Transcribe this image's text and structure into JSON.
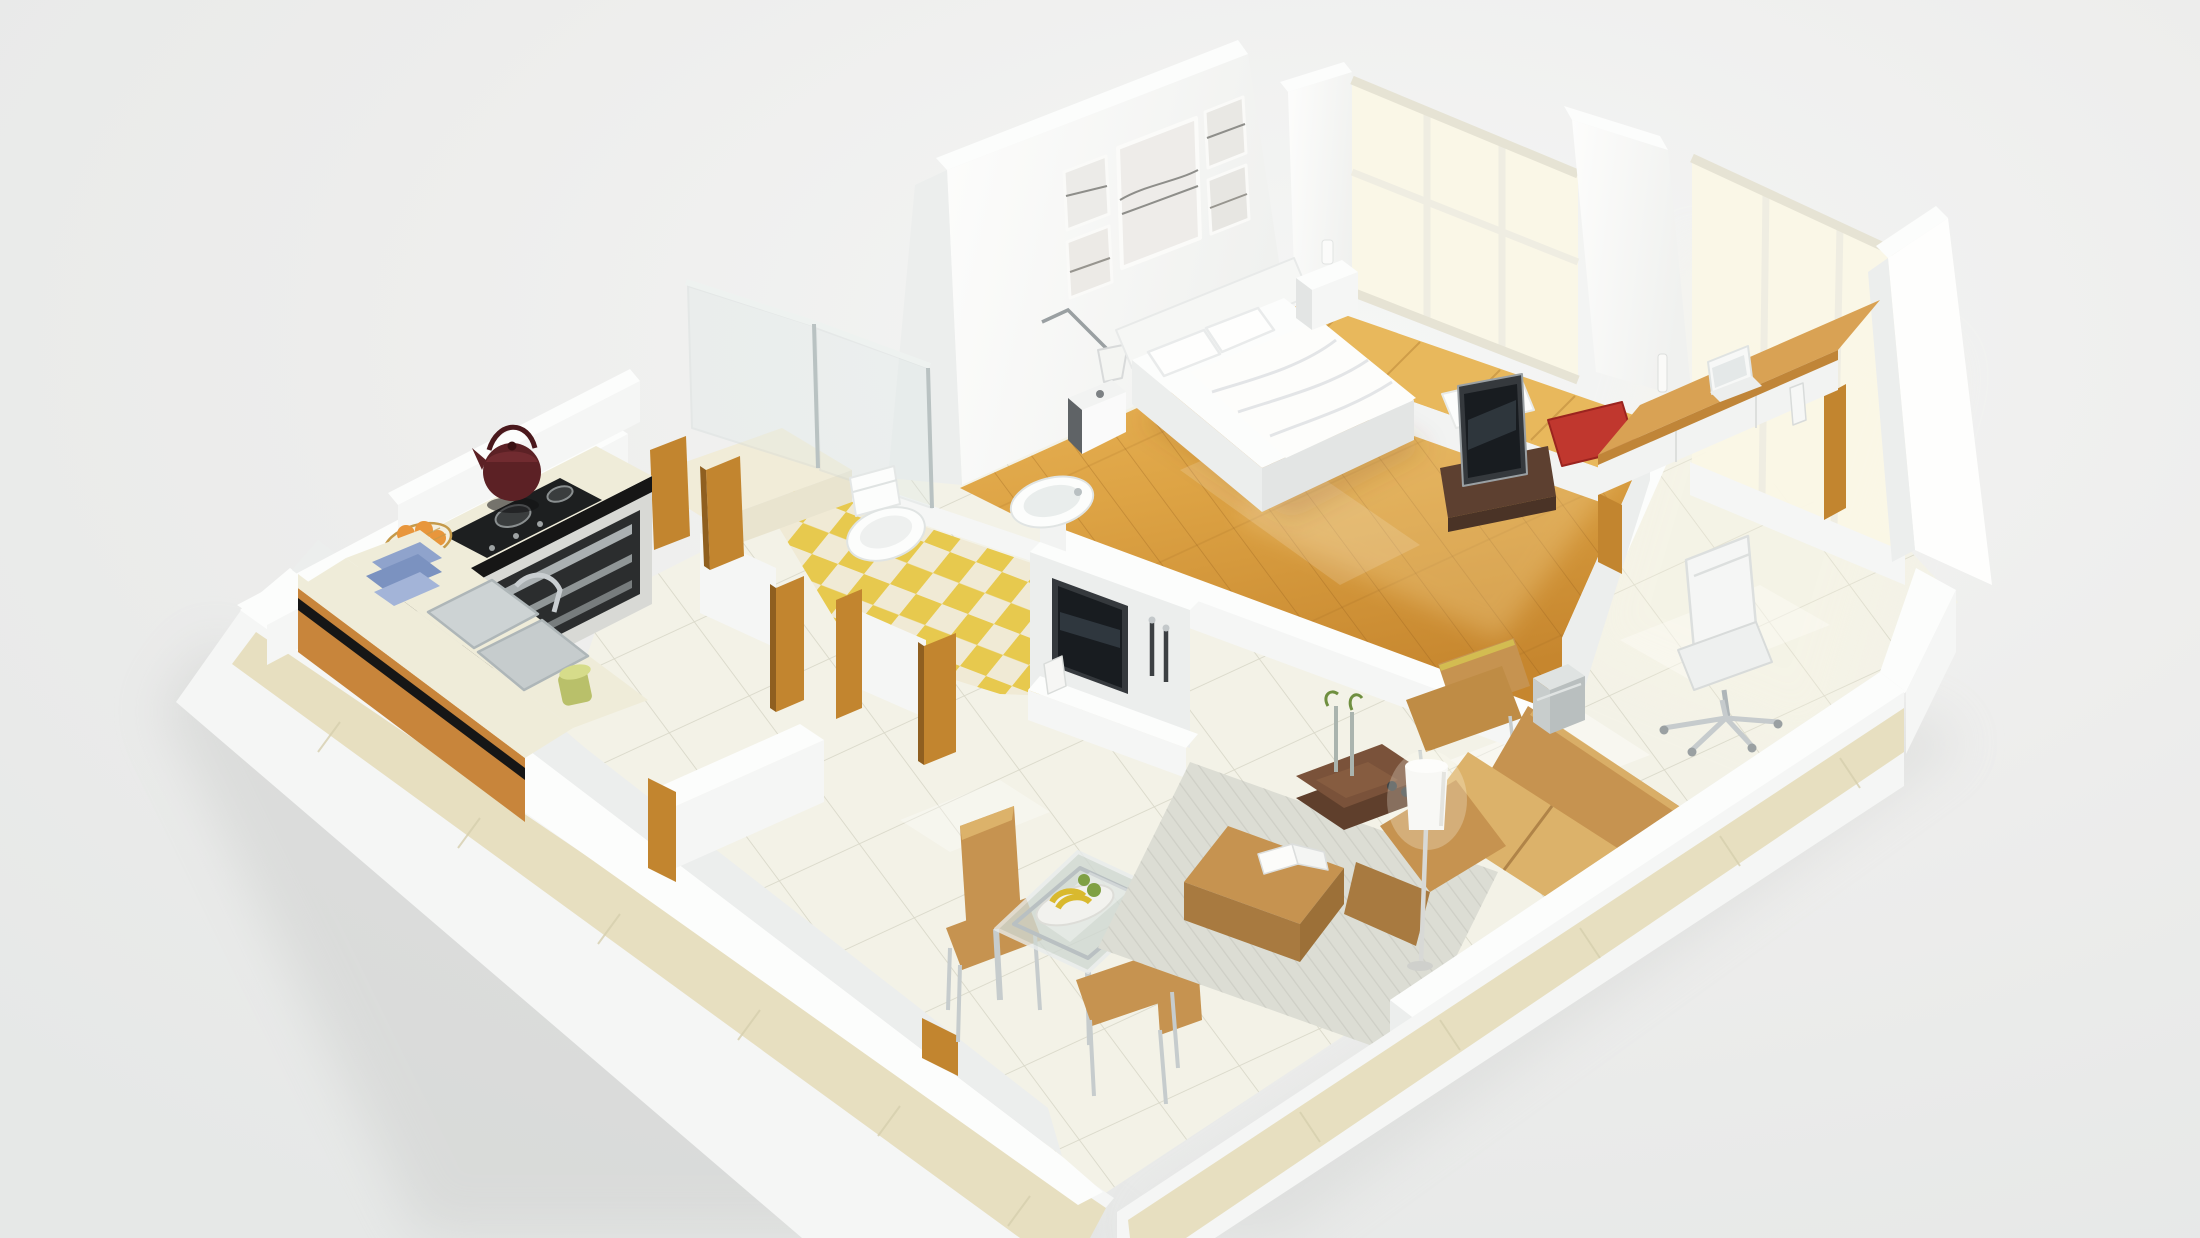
{
  "scene": {
    "type": "3d-floorplan-render",
    "view": "isometric-cutaway-perspective",
    "description": "Photorealistic 3D cutaway floor plan of a one-bedroom apartment seen from above",
    "text_content": "none"
  },
  "rooms": [
    {
      "id": "kitchen",
      "area": "west",
      "floor": "white-tile",
      "features": [
        "L-shaped counter with cream stone top",
        "orange cabinet fronts with black trim stripe",
        "two-burner black gas cooktop",
        "dark red kettle",
        "wire fruit basket with oranges",
        "stacked blue dishes",
        "double stainless sink with chrome faucet",
        "green glass jar",
        "built-in stainless oven"
      ]
    },
    {
      "id": "bathroom",
      "area": "center",
      "floor": "yellow-cream-checkerboard",
      "features": [
        "white toilet",
        "white pedestal sink",
        "glass shower enclosure with chrome frame",
        "raised shower step"
      ]
    },
    {
      "id": "bedroom",
      "area": "north",
      "floor": "orange-wood-plank",
      "features": [
        "white double bed with duvet and pillows",
        "tall headboard wall with five picture frames",
        "swing-arm reading lamp",
        "dark and white nightstands",
        "flat-screen TV on low wood stand",
        "bay window seat with white and red cushions"
      ]
    },
    {
      "id": "study",
      "area": "east",
      "floor": "white-tile",
      "features": [
        "wall-length wooden desk",
        "white laptop",
        "slim white office chair with chrome star base",
        "floor-to-ceiling windows"
      ]
    },
    {
      "id": "living",
      "area": "south-east",
      "floor": "white-tile",
      "features": [
        "tan leather sectional sofa",
        "tan lounge chaise",
        "tan ottoman with open magazine",
        "dark wood coffee table with slim vases and plant sprigs",
        "white cylindrical floor lamp",
        "silver cube side table",
        "pale striped area rug",
        "wall TV with white media console",
        "two dark candlestick holders"
      ]
    },
    {
      "id": "dining",
      "area": "south-center",
      "floor": "white-tile",
      "features": [
        "square glass-top table with chrome legs",
        "two tan high-back dining chairs",
        "plate with bananas and green fruit"
      ]
    },
    {
      "id": "hall",
      "area": "center-west",
      "floor": "white-tile",
      "features": [
        "oak door jambs",
        "low white partition walls",
        "beige tiled skirt on outer walls"
      ]
    }
  ],
  "palette": {
    "background": "#ecedec",
    "wall_white": "#fcfdfc",
    "wall_light": "#f5f6f5",
    "wall_mid": "#eceeed",
    "wall_dark": "#e3e5e4",
    "tile_floor": "#f3f2e7",
    "tile_line": "#d9d8c9",
    "wood_light": "#e7b258",
    "wood_dark": "#c9882f",
    "checker_yellow": "#e7c94e",
    "checker_cream": "#f0ead5",
    "shower_floor": "#f1ecd8",
    "counter_cream": "#efecd9",
    "cabinet_orange": "#c8853b",
    "trim_black": "#161616",
    "door_wood": "#c2852f",
    "sofa_tan": "#c69350",
    "sofa_tan_light": "#dcb26a",
    "sofa_tan_dark": "#a87a40",
    "rug": "#dcddd4",
    "rug_line": "#cbccc3",
    "table_wood": "#7a523a",
    "tv_frame": "#35393d",
    "tv_screen": "#181c20",
    "chrome": "#c6cccd",
    "glass": "#dfe9e8",
    "window_glow": "#faf7e6",
    "red_cushion": "#c0372e",
    "teapot": "#5c2125",
    "dish_blue": "#8fa3cc",
    "fruit_orange": "#e8963c",
    "banana_yellow": "#e6c83e",
    "leaf_green": "#7fa043",
    "skirt_beige": "#e7dfc0",
    "steel": "#aab0b2",
    "shadow": "#c9cbc9"
  }
}
